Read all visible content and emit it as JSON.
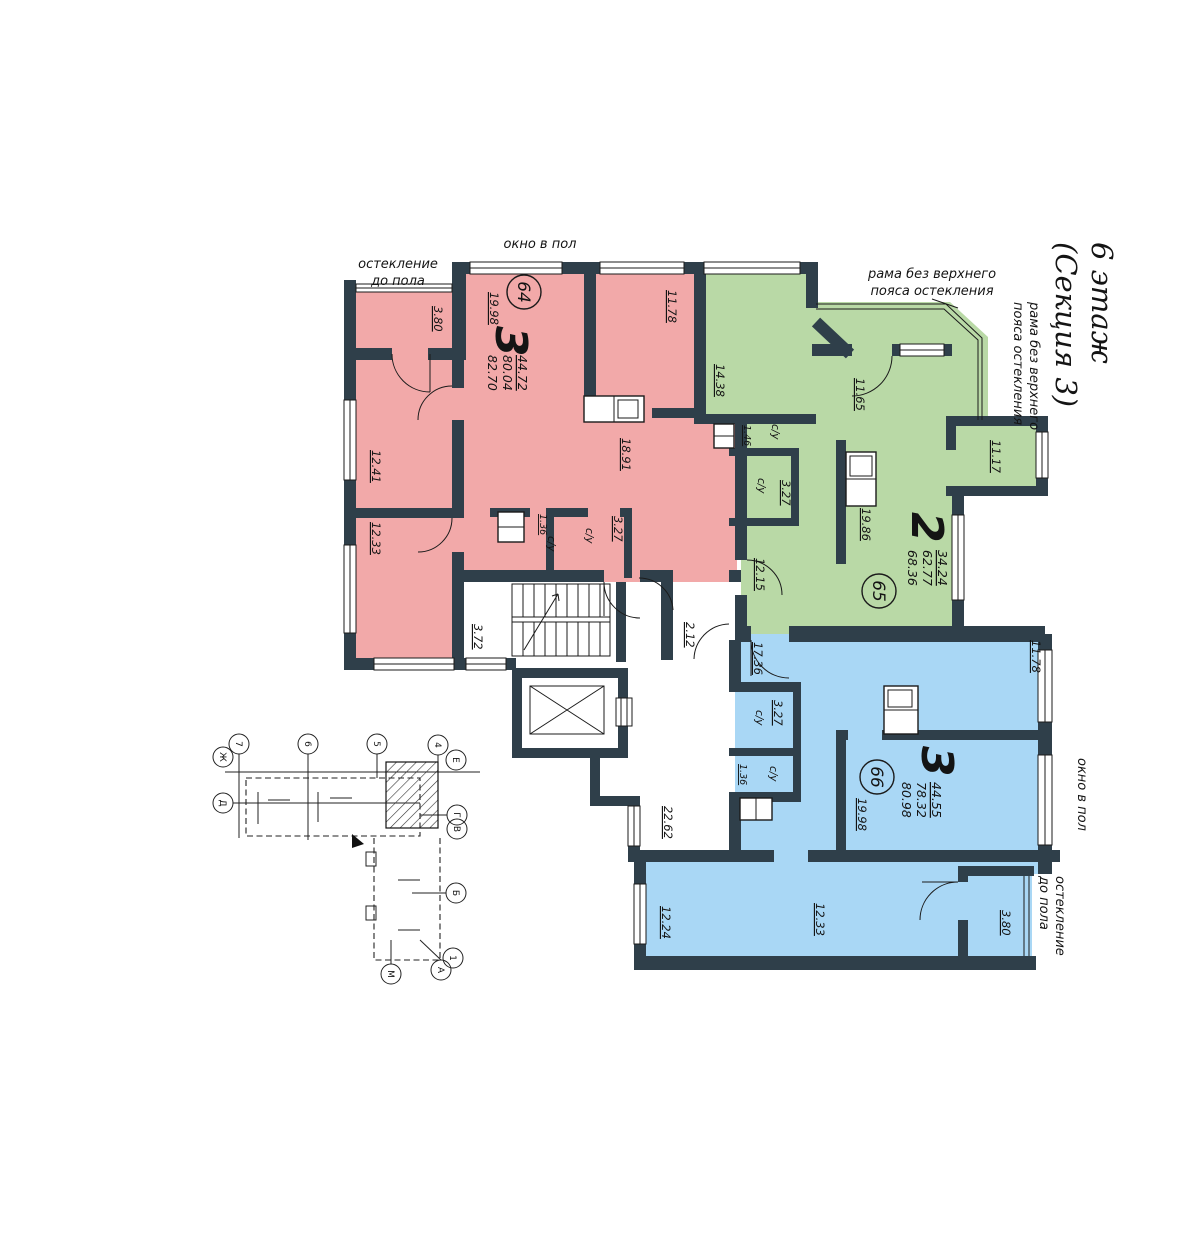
{
  "title": {
    "floor": "6 этаж",
    "section": "(Секция 3)"
  },
  "annotations": {
    "window_full_top": "окно в пол",
    "window_full_right": "окно в пол",
    "glazing1": "остекление",
    "glazing2": "до пола",
    "frame1": "рама без верхнего",
    "frame2": "пояса остекления"
  },
  "labels": {
    "wc": "с/у"
  },
  "apartments": {
    "a64": {
      "num": "64",
      "rooms": "3",
      "area_living": "44.72",
      "area": "80.04",
      "area_total": "82.70",
      "r_living": "19.98",
      "r1": "11.78",
      "kitchen": "18.91",
      "r2": "12.41",
      "r3": "12.33",
      "wc_small": "1.36",
      "wc": "3.27",
      "balcony": "3.80"
    },
    "a65": {
      "num": "65",
      "rooms": "2",
      "area_living": "34.24",
      "area": "62.77",
      "area_total": "68.36",
      "r1": "14.38",
      "hall": "11.65",
      "loggia": "11.17",
      "wc_small": "1.46",
      "wc": "3.27",
      "kitchen": "19.86",
      "entry": "12.15"
    },
    "a66": {
      "num": "66",
      "rooms": "3",
      "area_living": "44.55",
      "area": "78.32",
      "area_total": "80.98",
      "hall": "17.36",
      "r1": "11.78",
      "wc": "3.27",
      "wc_small": "1.36",
      "kitchen": "19.98",
      "r2": "12.24",
      "r3": "12.33",
      "balcony": "3.80"
    }
  },
  "common": {
    "stair_hall": "3.72",
    "vestibule": "2.12",
    "lobby": "22.62"
  },
  "key_plan": {
    "axes": [
      "7",
      "6",
      "5",
      "4",
      "Е",
      "Ж",
      "Д",
      "Г",
      "В",
      "Б",
      "М",
      "А",
      "1"
    ]
  },
  "colors": {
    "apt64": "#F2A9A9",
    "apt65": "#B9D9A6",
    "apt66": "#A9D7F5",
    "wall": "#2F3F4A"
  }
}
